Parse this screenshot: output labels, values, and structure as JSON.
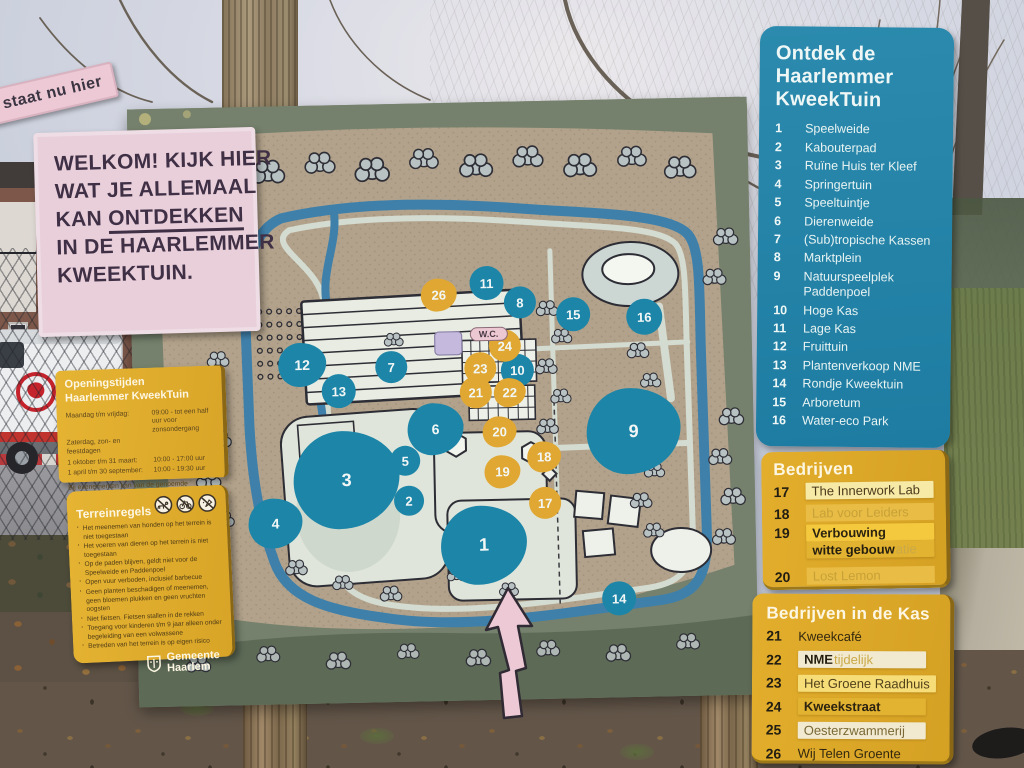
{
  "welcome_sign": {
    "lines": [
      "WELKOM! KIJK HIER",
      "WAT JE ALLEMAAL",
      "KAN |ONTDEKKEN|",
      "IN DE HAARLEMMER",
      "KWEEKTUIN."
    ]
  },
  "opening_sign": {
    "title_lines": [
      "Openingstijden",
      "Haarlemmer KweekTuin"
    ],
    "rows": [
      {
        "label": "Maandag t/m vrijdag:",
        "value": "09:00 - tot een half uur voor zonsondergang"
      },
      {
        "label": "Zaterdag, zon- en feestdagen",
        "value": ""
      },
      {
        "label": "1 oktober t/m 31 maart:",
        "value": "10:00 - 17:00 uur"
      },
      {
        "label": "1 april t/m 30 september:",
        "value": "10:00 - 19:30 uur"
      }
    ],
    "footnote": "Bij evenementen kan van de genoemde openingstijden worden afgeweken."
  },
  "rules_sign": {
    "title": "Terreinregels",
    "icons": [
      "no-dogs-icon",
      "no-cycling-icon",
      "no-feeding-icon"
    ],
    "rules": [
      "Het meenemen van honden op het terrein is niet toegestaan",
      "Het voeren van dieren op het terrein is niet toegestaan",
      "Op de paden blijven, geldt niet voor de Speelweide en Paddenpoel",
      "Open vuur verboden, inclusief barbecue",
      "Geen planten beschadigen of meenemen, geen bloemen plukken en geen vruchten oogsten",
      "Niet fietsen. Fietsen stallen in de rekken",
      "Toegang voor kinderen t/m 9 jaar alleen onder begeleiding van een volwassene",
      "Betreden van het terrein is op eigen risico"
    ],
    "logo_lines": [
      "Gemeente",
      "Haarlem"
    ]
  },
  "legend_panel": {
    "title_lines": [
      "Ontdek de",
      "Haarlemmer",
      "KweekTuin"
    ],
    "items": [
      {
        "number": "1",
        "label": "Speelweide"
      },
      {
        "number": "2",
        "label": "Kabouterpad"
      },
      {
        "number": "3",
        "label": "Ruïne Huis ter Kleef"
      },
      {
        "number": "4",
        "label": "Springertuin"
      },
      {
        "number": "5",
        "label": "Speeltuintje"
      },
      {
        "number": "6",
        "label": "Dierenweide"
      },
      {
        "number": "7",
        "label": "(Sub)tropische Kassen"
      },
      {
        "number": "8",
        "label": "Marktplein"
      },
      {
        "number": "9",
        "label": "Natuurspeelplek Paddenpoel"
      },
      {
        "number": "10",
        "label": "Hoge Kas"
      },
      {
        "number": "11",
        "label": "Lage Kas"
      },
      {
        "number": "12",
        "label": "Fruittuin"
      },
      {
        "number": "13",
        "label": "Plantenverkoop NME"
      },
      {
        "number": "14",
        "label": "Rondje Kweektuin"
      },
      {
        "number": "15",
        "label": "Arboretum"
      },
      {
        "number": "16",
        "label": "Water-eco Park"
      }
    ]
  },
  "bedrijven_panel": {
    "title": "Bedrijven",
    "items": [
      {
        "number": "17",
        "label": "The Innerwork Lab",
        "style": "sticker",
        "tone": "tone-light"
      },
      {
        "number": "18",
        "label": "Lab voor Leiders",
        "style": "faded"
      },
      {
        "number": "19",
        "label": "Verbouwing",
        "style": "sticker",
        "tone": "tone-bright",
        "label2": "witte gebouw",
        "label2_ghost": "atie"
      },
      {
        "number": "20",
        "label": "Lost Lemon",
        "style": "faded"
      }
    ]
  },
  "kas_panel": {
    "title": "Bedrijven in de Kas",
    "items": [
      {
        "number": "21",
        "label": "Kweekcafé",
        "style": "plain"
      },
      {
        "number": "22",
        "label": "NME",
        "style": "sticker",
        "tone": "tone-paper",
        "bold": true,
        "ghost": "tijdelijk"
      },
      {
        "number": "23",
        "label": "Het Groene Raadhuis",
        "style": "sticker",
        "tone": "tone-lemon"
      },
      {
        "number": "24",
        "label": "Kweekstraat",
        "style": "sticker",
        "tone": "tone-dirty"
      },
      {
        "number": "25",
        "label": "Oesterzwammerij",
        "style": "sticker",
        "tone": "tone-paper"
      },
      {
        "number": "26",
        "label": "Wij Telen Groente",
        "style": "plain"
      }
    ]
  },
  "map": {
    "wc_label": "W.C.",
    "you_are_here": "Je staat nu hier",
    "markers": [
      {
        "n": "1",
        "c": "teal",
        "x": 348,
        "y": 443,
        "d": 86,
        "blob": true
      },
      {
        "n": "2",
        "c": "teal",
        "x": 274,
        "y": 397,
        "d": 30,
        "blob": false
      },
      {
        "n": "3",
        "c": "teal",
        "x": 212,
        "y": 375,
        "d": 106,
        "blob": true
      },
      {
        "n": "4",
        "c": "teal",
        "x": 140,
        "y": 417,
        "d": 54,
        "blob": true
      },
      {
        "n": "5",
        "c": "teal",
        "x": 271,
        "y": 357,
        "d": 30,
        "blob": false
      },
      {
        "n": "6",
        "c": "teal",
        "x": 302,
        "y": 326,
        "d": 56,
        "blob": true
      },
      {
        "n": "7",
        "c": "teal",
        "x": 259,
        "y": 263,
        "d": 32,
        "blob": false
      },
      {
        "n": "8",
        "c": "teal",
        "x": 389,
        "y": 201,
        "d": 32,
        "blob": false
      },
      {
        "n": "9",
        "c": "teal",
        "x": 500,
        "y": 332,
        "d": 94,
        "blob": true
      },
      {
        "n": "10",
        "c": "teal",
        "x": 385,
        "y": 269,
        "d": 33,
        "blob": false
      },
      {
        "n": "11",
        "c": "teal",
        "x": 356,
        "y": 181,
        "d": 34,
        "blob": false
      },
      {
        "n": "12",
        "c": "teal",
        "x": 170,
        "y": 259,
        "d": 48,
        "blob": true
      },
      {
        "n": "13",
        "c": "teal",
        "x": 206,
        "y": 286,
        "d": 34,
        "blob": false
      },
      {
        "n": "14",
        "c": "teal",
        "x": 482,
        "y": 499,
        "d": 34,
        "blob": false
      },
      {
        "n": "15",
        "c": "teal",
        "x": 442,
        "y": 214,
        "d": 34,
        "blob": false
      },
      {
        "n": "16",
        "c": "teal",
        "x": 513,
        "y": 218,
        "d": 36,
        "blob": false
      },
      {
        "n": "17",
        "c": "yellow",
        "x": 410,
        "y": 402,
        "d": 32,
        "blob": false
      },
      {
        "n": "18",
        "c": "yellow",
        "x": 410,
        "y": 356,
        "d": 34,
        "blob": true
      },
      {
        "n": "19",
        "c": "yellow",
        "x": 368,
        "y": 370,
        "d": 36,
        "blob": true
      },
      {
        "n": "20",
        "c": "yellow",
        "x": 366,
        "y": 330,
        "d": 34,
        "blob": true
      },
      {
        "n": "21",
        "c": "yellow",
        "x": 343,
        "y": 290,
        "d": 32,
        "blob": false
      },
      {
        "n": "22",
        "c": "yellow",
        "x": 377,
        "y": 291,
        "d": 32,
        "blob": true
      },
      {
        "n": "23",
        "c": "yellow",
        "x": 348,
        "y": 266,
        "d": 32,
        "blob": false
      },
      {
        "n": "24",
        "c": "yellow",
        "x": 373,
        "y": 244,
        "d": 32,
        "blob": false
      },
      {
        "n": "26",
        "c": "yellow",
        "x": 308,
        "y": 192,
        "d": 36,
        "blob": true
      }
    ]
  },
  "colors": {
    "panel_blue": "#2585ab",
    "panel_yellow": "#e0aa28",
    "marker_teal": "#1d85a8",
    "marker_yellow": "#e0a733",
    "sign_pink": "#e9cfda",
    "board_green": "#75816c",
    "water_blue": "#3f80ab"
  }
}
